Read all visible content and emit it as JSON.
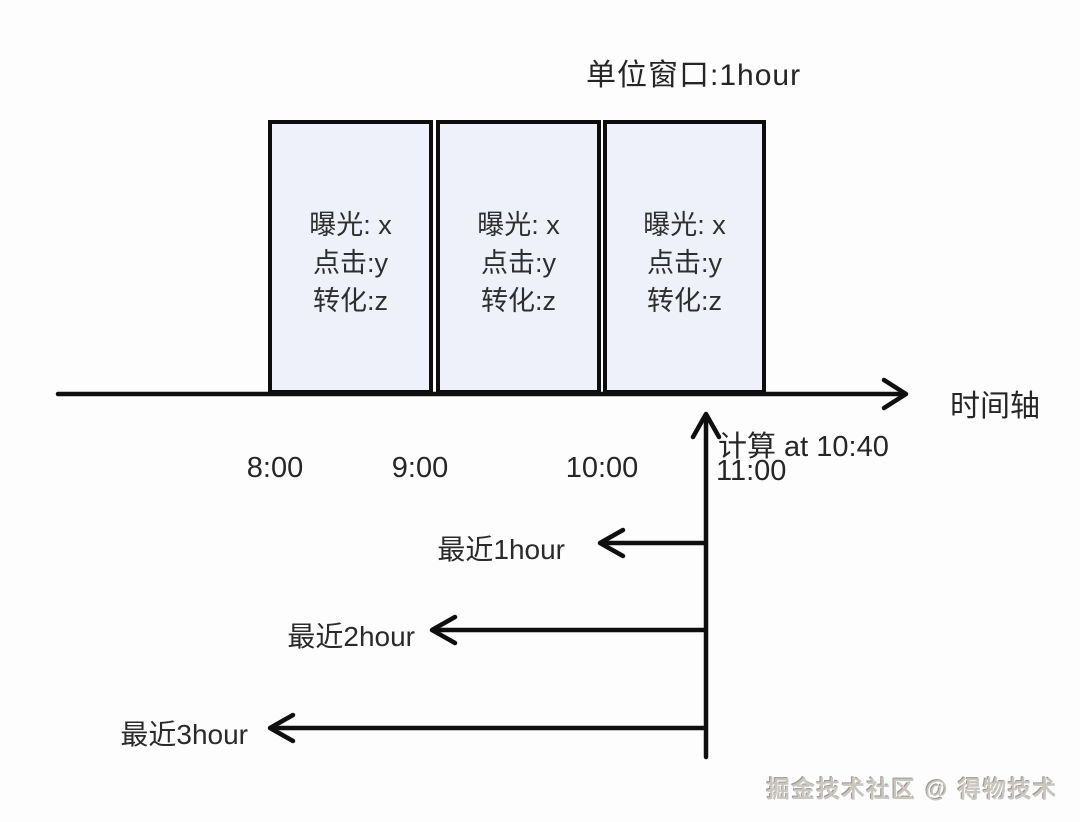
{
  "title": "单位窗口:1hour",
  "boxes": [
    {
      "lines": [
        "曝光: x",
        "点击:y",
        "转化:z"
      ]
    },
    {
      "lines": [
        "曝光: x",
        "点击:y",
        "转化:z"
      ]
    },
    {
      "lines": [
        "曝光: x",
        "点击:y",
        "转化:z"
      ]
    }
  ],
  "timeline": {
    "axis_label": "时间轴",
    "ticks": [
      "8:00",
      "9:00",
      "10:00",
      "11:00"
    ]
  },
  "annotation": {
    "calc_text": "计算 at 10:40"
  },
  "ranges": [
    {
      "label": "最近1hour"
    },
    {
      "label": "最近2hour"
    },
    {
      "label": "最近3hour"
    }
  ],
  "watermark": "掘金技术社区 @ 得物技术",
  "colors": {
    "box_fill": "#eef1f9",
    "line": "#0f0f0f",
    "text": "#2b2b2b",
    "watermark": "#c9c6c0"
  }
}
